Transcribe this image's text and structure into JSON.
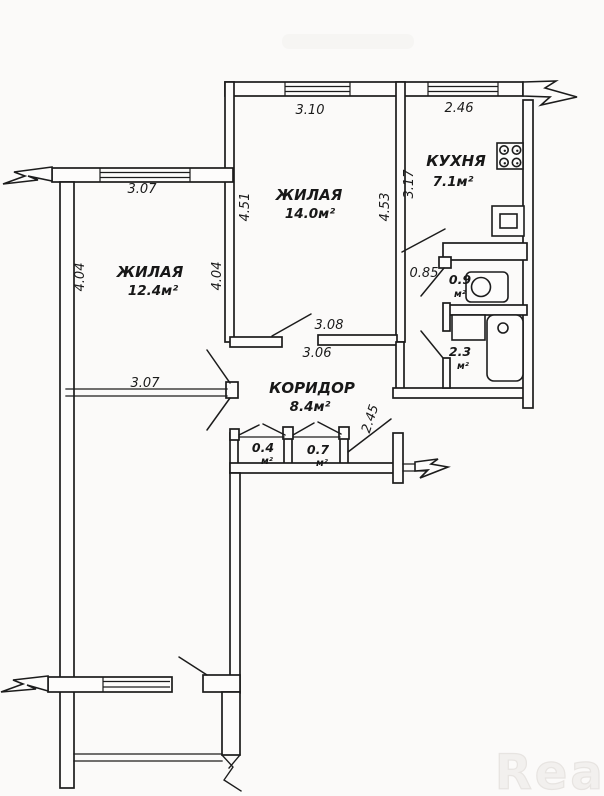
{
  "document": {
    "kind": "apartment-floor-plan"
  },
  "watermark": {
    "text": "Real"
  },
  "rooms": {
    "living_main": {
      "name": "ЖИЛАЯ",
      "area": "14.0м²"
    },
    "living_left": {
      "name": "ЖИЛАЯ",
      "area": "12.4м²"
    },
    "kitchen": {
      "name": "КУХНЯ",
      "area": "7.1м²"
    },
    "corridor": {
      "name": "КОРИДОР",
      "area": "8.4м²"
    },
    "wc": {
      "area": "0.9",
      "unit": "м²"
    },
    "bathroom": {
      "area": "2.3",
      "unit": "м²"
    },
    "closet_small": {
      "area": "0.4",
      "unit": "м²"
    },
    "closet_big": {
      "area": "0.7",
      "unit": "м²"
    }
  },
  "dimensions": {
    "living_main_top": "3.10",
    "living_main_left": "4.51",
    "living_main_right": "4.53",
    "kitchen_top": "2.46",
    "kitchen_left": "3.17",
    "hall_width": "0.85",
    "living_left_top": "3.07",
    "living_left_left": "4.04",
    "living_left_right": "4.04",
    "living_left_bottom": "3.07",
    "corridor_top_a": "3.08",
    "corridor_top_b": "3.06",
    "corridor_right": "2.45"
  },
  "colors": {
    "ink": "#1c1c1c",
    "paper": "#fbfaf9"
  }
}
